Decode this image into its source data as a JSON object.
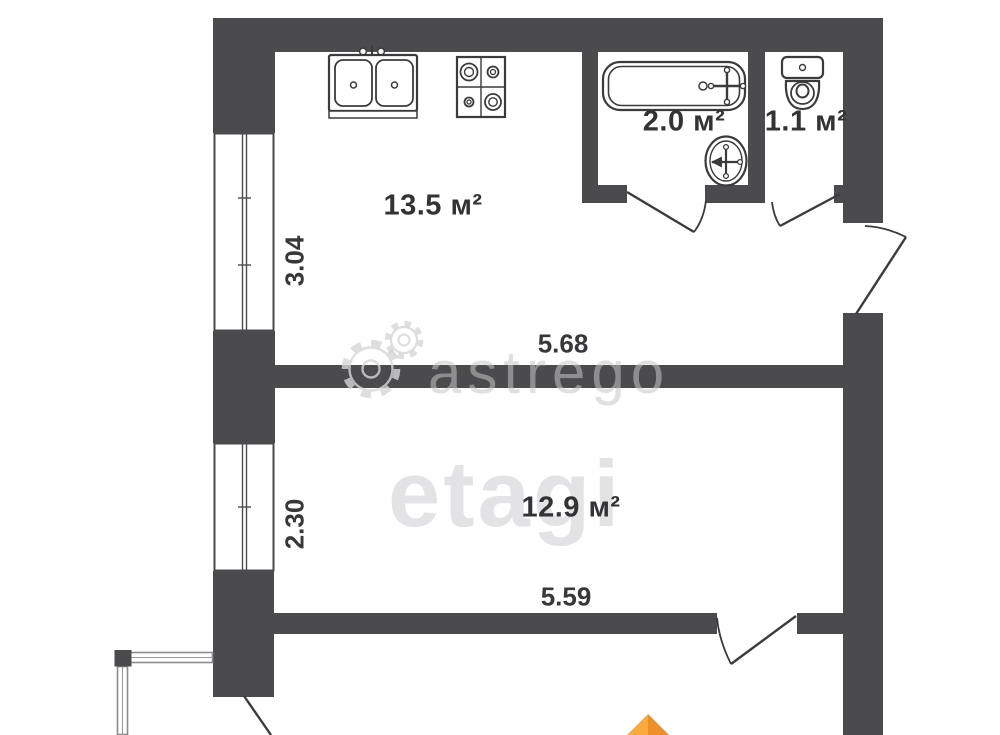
{
  "plan_type": "apartment-floor-plan",
  "rooms": {
    "kitchen": {
      "area_label": "13.5 м²"
    },
    "bathroom": {
      "area_label": "2.0 м²"
    },
    "toilet": {
      "area_label": "1.1 м²"
    },
    "living_room": {
      "area_label": "12.9 м²"
    }
  },
  "dimensions": {
    "kitchen_window_width": "3.04",
    "kitchen_length": "5.68",
    "living_room_window_width": "2.30",
    "living_room_length": "5.59"
  },
  "watermarks": {
    "astrego_text": "astrego",
    "etagi_text": "etagi"
  },
  "icons": {
    "watermark": "gears-icon",
    "logo_arrow": "orange-arrow-icon",
    "fixtures": [
      "kitchen-sink-icon",
      "stove-icon",
      "bathtub-icon",
      "wash-basin-icon",
      "toilet-icon"
    ]
  },
  "colors": {
    "wall": "#4b4b4d",
    "line": "#3b3b3d",
    "watermark_gray": "#dcdcdc",
    "accent_orange": "#f49b30"
  }
}
